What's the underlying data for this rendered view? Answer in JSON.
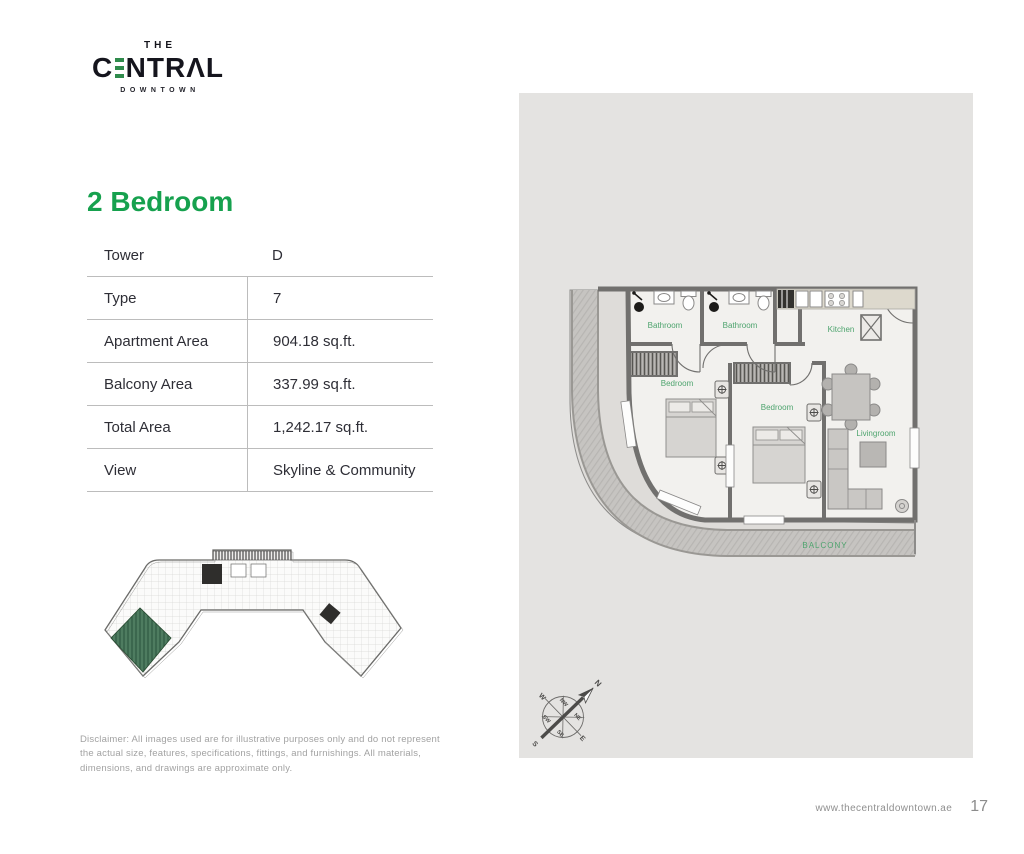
{
  "brand": {
    "the": "THE",
    "name_prefix": "C",
    "name_suffix": "NTRΛL",
    "subtitle": "DOWNTOWN"
  },
  "heading": "2 Bedroom",
  "specs": {
    "rows": [
      {
        "label": "Tower",
        "value": "D"
      },
      {
        "label": "Type",
        "value": "7"
      },
      {
        "label": "Apartment Area",
        "value": "904.18 sq.ft."
      },
      {
        "label": "Balcony Area",
        "value": "337.99 sq.ft."
      },
      {
        "label": "Total Area",
        "value": "1,242.17 sq.ft."
      },
      {
        "label": "View",
        "value": "Skyline & Community"
      }
    ]
  },
  "floorplan": {
    "labels": {
      "bathroom1": "Bathroom",
      "bathroom2": "Bathroom",
      "kitchen": "Kitchen",
      "bedroom1": "Bedroom",
      "bedroom2": "Bedroom",
      "livingroom": "Livingroom",
      "balcony": "BALCONY"
    },
    "label_color": "#4ea46e"
  },
  "compass": {
    "directions": {
      "n": "N",
      "ne": "NE",
      "e": "E",
      "se": "SE",
      "s": "S",
      "sw": "SW",
      "w": "W",
      "nw": "NW"
    }
  },
  "disclaimer": "Disclaimer: All images used are for illustrative purposes only and do not represent the actual size, features, specifications, fittings, and furnishings. All materials, dimensions, and drawings are approximate only.",
  "footer": {
    "website": "www.thecentraldowntown.ae",
    "page_number": "17"
  },
  "colors": {
    "accent_green": "#16a14e",
    "logo_bar_green": "#2f8b4c",
    "panel_gray": "#e4e3e1",
    "wall_gray": "#71706e",
    "highlight_unit_green": "#4e7c60"
  }
}
